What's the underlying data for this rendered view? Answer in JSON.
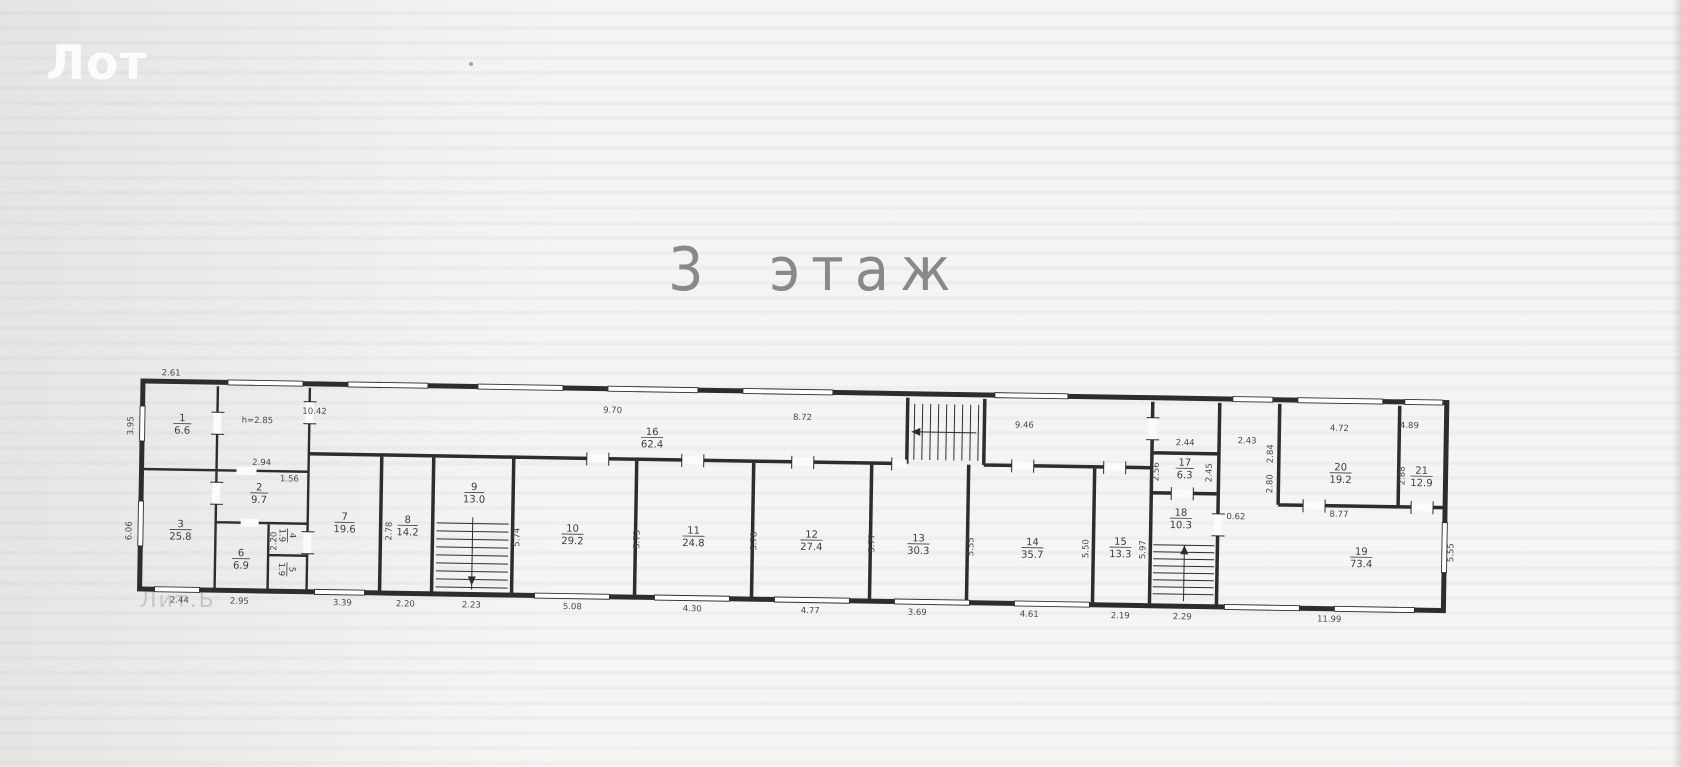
{
  "page": {
    "watermark": "Лот",
    "title": "3 этаж"
  },
  "plan": {
    "building_label": "Лит.Б",
    "rooms": [
      {
        "number": "1",
        "area": "6.6"
      },
      {
        "number": "2",
        "area": "9.7"
      },
      {
        "number": "3",
        "area": "25.8"
      },
      {
        "number": "4",
        "area": "1.9"
      },
      {
        "number": "5",
        "area": "1.9"
      },
      {
        "number": "6",
        "area": "6.9"
      },
      {
        "number": "7",
        "area": "19.6"
      },
      {
        "number": "8",
        "area": "14.2"
      },
      {
        "number": "9",
        "area": "13.0"
      },
      {
        "number": "10",
        "area": "29.2"
      },
      {
        "number": "11",
        "area": "24.8"
      },
      {
        "number": "12",
        "area": "27.4"
      },
      {
        "number": "13",
        "area": "30.3"
      },
      {
        "number": "14",
        "area": "35.7"
      },
      {
        "number": "15",
        "area": "13.3"
      },
      {
        "number": "16",
        "area": "62.4"
      },
      {
        "number": "17",
        "area": "6.3"
      },
      {
        "number": "18",
        "area": "10.3"
      },
      {
        "number": "19",
        "area": "73.4"
      },
      {
        "number": "20",
        "area": "19.2"
      },
      {
        "number": "21",
        "area": "12.9"
      }
    ],
    "dims_top": [
      "2.61",
      "10.42",
      "9.70",
      "8.72",
      "9.46",
      "2.44",
      "2.43",
      "4.72",
      "4.89"
    ],
    "dims_bottom": [
      "2.44",
      "2.95",
      "3.39",
      "2.20",
      "2.23",
      "5.08",
      "4.30",
      "4.77",
      "3.69",
      "4.61",
      "2.19",
      "2.29",
      "11.99"
    ],
    "dims_left": [
      "3.95",
      "6.06"
    ],
    "dims_right": [
      "5.55"
    ],
    "dims_interior": [
      "h=2.85",
      "2.94",
      "1.56",
      "2.78",
      "5.74",
      "5.73",
      "5.78",
      "5.77",
      "5.55",
      "5.50",
      "5.97",
      "2.56",
      "2.45",
      "0.62",
      "8.77",
      "2.84",
      "2.80",
      "2.88",
      "2.20"
    ]
  }
}
